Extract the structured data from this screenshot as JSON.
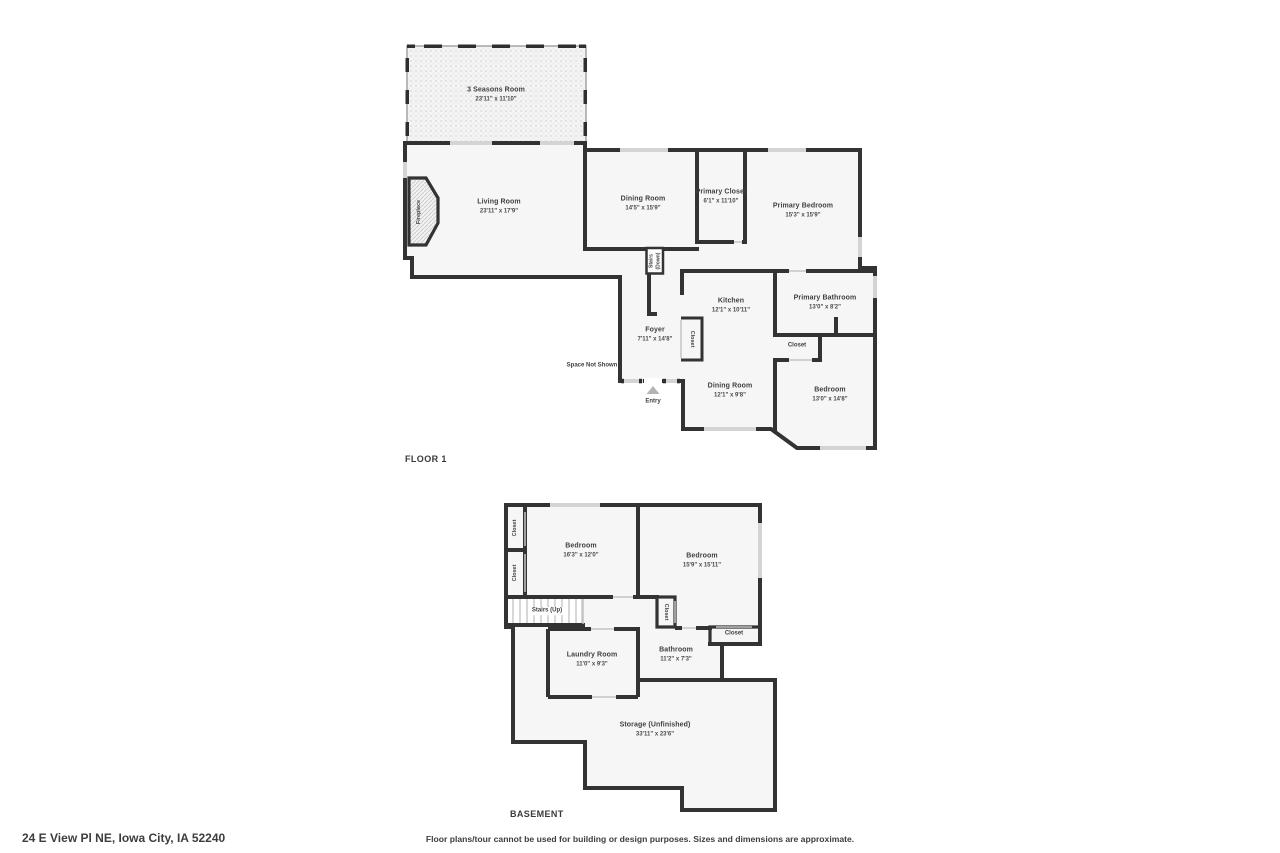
{
  "footer": {
    "address": "24 E View Pl NE, Iowa City, IA 52240",
    "disclaimer": "Floor plans/tour cannot be used for building or design purposes. Sizes and dimensions are approximate."
  },
  "colors": {
    "wall": "#333333",
    "room_fill": "#f6f6f6",
    "window": "#d4d4d4",
    "text": "#3f3f3f"
  },
  "floor1": {
    "title": "FLOOR 1",
    "rooms": {
      "seasons": {
        "name": "3 Seasons Room",
        "dims": "23'11\" x 11'10\""
      },
      "living": {
        "name": "Living Room",
        "dims": "23'11\" x 17'9\""
      },
      "dining1": {
        "name": "Dining Room",
        "dims": "14'5\" x 15'9\""
      },
      "primary_closet": {
        "name": "Primary Closet",
        "dims": "6'1\" x 11'10\""
      },
      "primary_bedroom": {
        "name": "Primary Bedroom",
        "dims": "15'3\" x 15'9\""
      },
      "kitchen": {
        "name": "Kitchen",
        "dims": "12'1\" x 10'11\""
      },
      "primary_bathroom": {
        "name": "Primary Bathroom",
        "dims": "13'0\" x 8'2\""
      },
      "foyer": {
        "name": "Foyer",
        "dims": "7'11\" x 14'8\""
      },
      "dining2": {
        "name": "Dining Room",
        "dims": "12'1\" x 9'8\""
      },
      "bedroom": {
        "name": "Bedroom",
        "dims": "13'0\" x 14'8\""
      },
      "hall_closet": "Closet",
      "foyer_closet": "Closet",
      "fireplace": "Fireplace",
      "stairs_down": "Stairs (Down)",
      "space_not_shown": "Space Not Shown",
      "entry": "Entry"
    }
  },
  "basement": {
    "title": "BASEMENT",
    "rooms": {
      "bedroom1": {
        "name": "Bedroom",
        "dims": "16'3\" x 12'0\""
      },
      "bedroom2": {
        "name": "Bedroom",
        "dims": "15'9\" x 15'11\""
      },
      "laundry": {
        "name": "Laundry Room",
        "dims": "11'0\" x 9'3\""
      },
      "bathroom": {
        "name": "Bathroom",
        "dims": "11'2\" x 7'3\""
      },
      "storage": {
        "name": "Storage (Unfinished)",
        "dims": "33'11\" x 23'6\""
      },
      "left_closet_top": "Closet",
      "left_closet_bottom": "Closet",
      "hall_closet_vert": "Closet",
      "hall_closet_horiz": "Closet",
      "stairs_up": "Stairs (Up)"
    }
  }
}
